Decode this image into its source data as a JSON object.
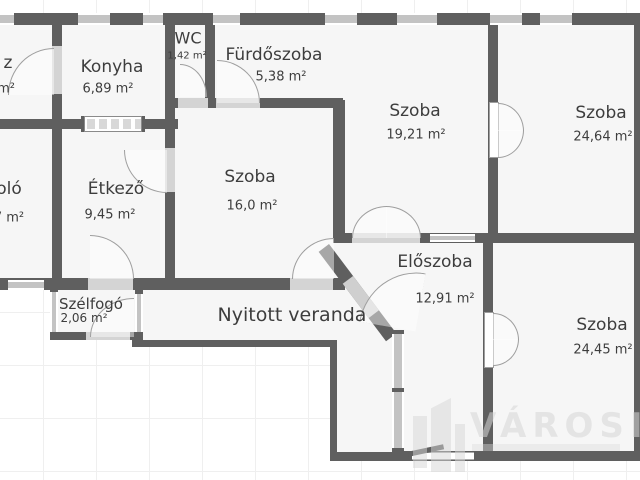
{
  "plan": {
    "type": "floor-plan",
    "rooms": [
      {
        "id": "cut-room-top-left",
        "label": "z",
        "area": "m²",
        "partial": true
      },
      {
        "id": "konyha",
        "label": "Konyha",
        "area": "6,89 m²"
      },
      {
        "id": "wc",
        "label": "WC",
        "area": "1,42 m²"
      },
      {
        "id": "furdoszoba",
        "label": "Fürdőszoba",
        "area": "5,38 m²"
      },
      {
        "id": "szoba-1",
        "label": "Szoba",
        "area": "19,21 m²"
      },
      {
        "id": "szoba-2",
        "label": "Szoba",
        "area": "24,64 m²"
      },
      {
        "id": "cut-room-left",
        "label": "oló",
        "area": "7 m²",
        "partial": true
      },
      {
        "id": "etkezo",
        "label": "Étkező",
        "area": "9,45 m²"
      },
      {
        "id": "szoba-3",
        "label": "Szoba",
        "area": "16,0 m²"
      },
      {
        "id": "eloszoba",
        "label": "Előszoba",
        "area": "12,91 m²"
      },
      {
        "id": "szelfogo",
        "label": "Szélfogó",
        "area": "2,06 m²"
      },
      {
        "id": "nyitott-veranda",
        "label": "Nyitott veranda",
        "area": ""
      },
      {
        "id": "szoba-4",
        "label": "Szoba",
        "area": "24,45 m²"
      }
    ],
    "watermark": {
      "brand": "VÁROSI",
      "logo": "building-icon"
    },
    "colors": {
      "wall": "#5f5f5f",
      "floor": "#f6f6f6",
      "door_sill": "#d4d4d4",
      "window": "#c3c3c3",
      "text": "#3d3d3d",
      "grid": "#efefef",
      "watermark": "#d5d5d5"
    }
  }
}
